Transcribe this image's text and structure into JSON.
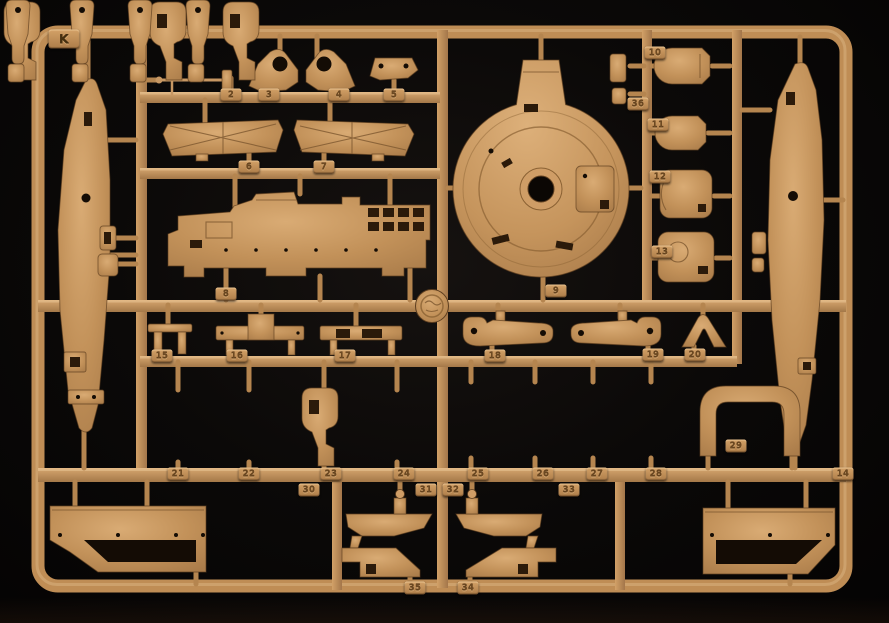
{
  "scene_description": "Photograph of a tan plastic injection-molded model kit sprue (parts tree) with numbered part tabs on a black background",
  "colors": {
    "plastic": "#c6955f",
    "plastic_light": "#dcae78",
    "plastic_dark": "#8a6138",
    "background": "#0b0908"
  },
  "sprue": {
    "letter": "K",
    "tabs": [
      "K",
      "2",
      "3",
      "4",
      "5",
      "6",
      "7",
      "8",
      "9",
      "10",
      "36",
      "11",
      "12",
      "13",
      "15",
      "16",
      "17",
      "18",
      "19",
      "20",
      "21",
      "22",
      "23",
      "24",
      "25",
      "26",
      "27",
      "28",
      "29",
      "14",
      "30",
      "31",
      "32",
      "33",
      "35",
      "34"
    ]
  }
}
